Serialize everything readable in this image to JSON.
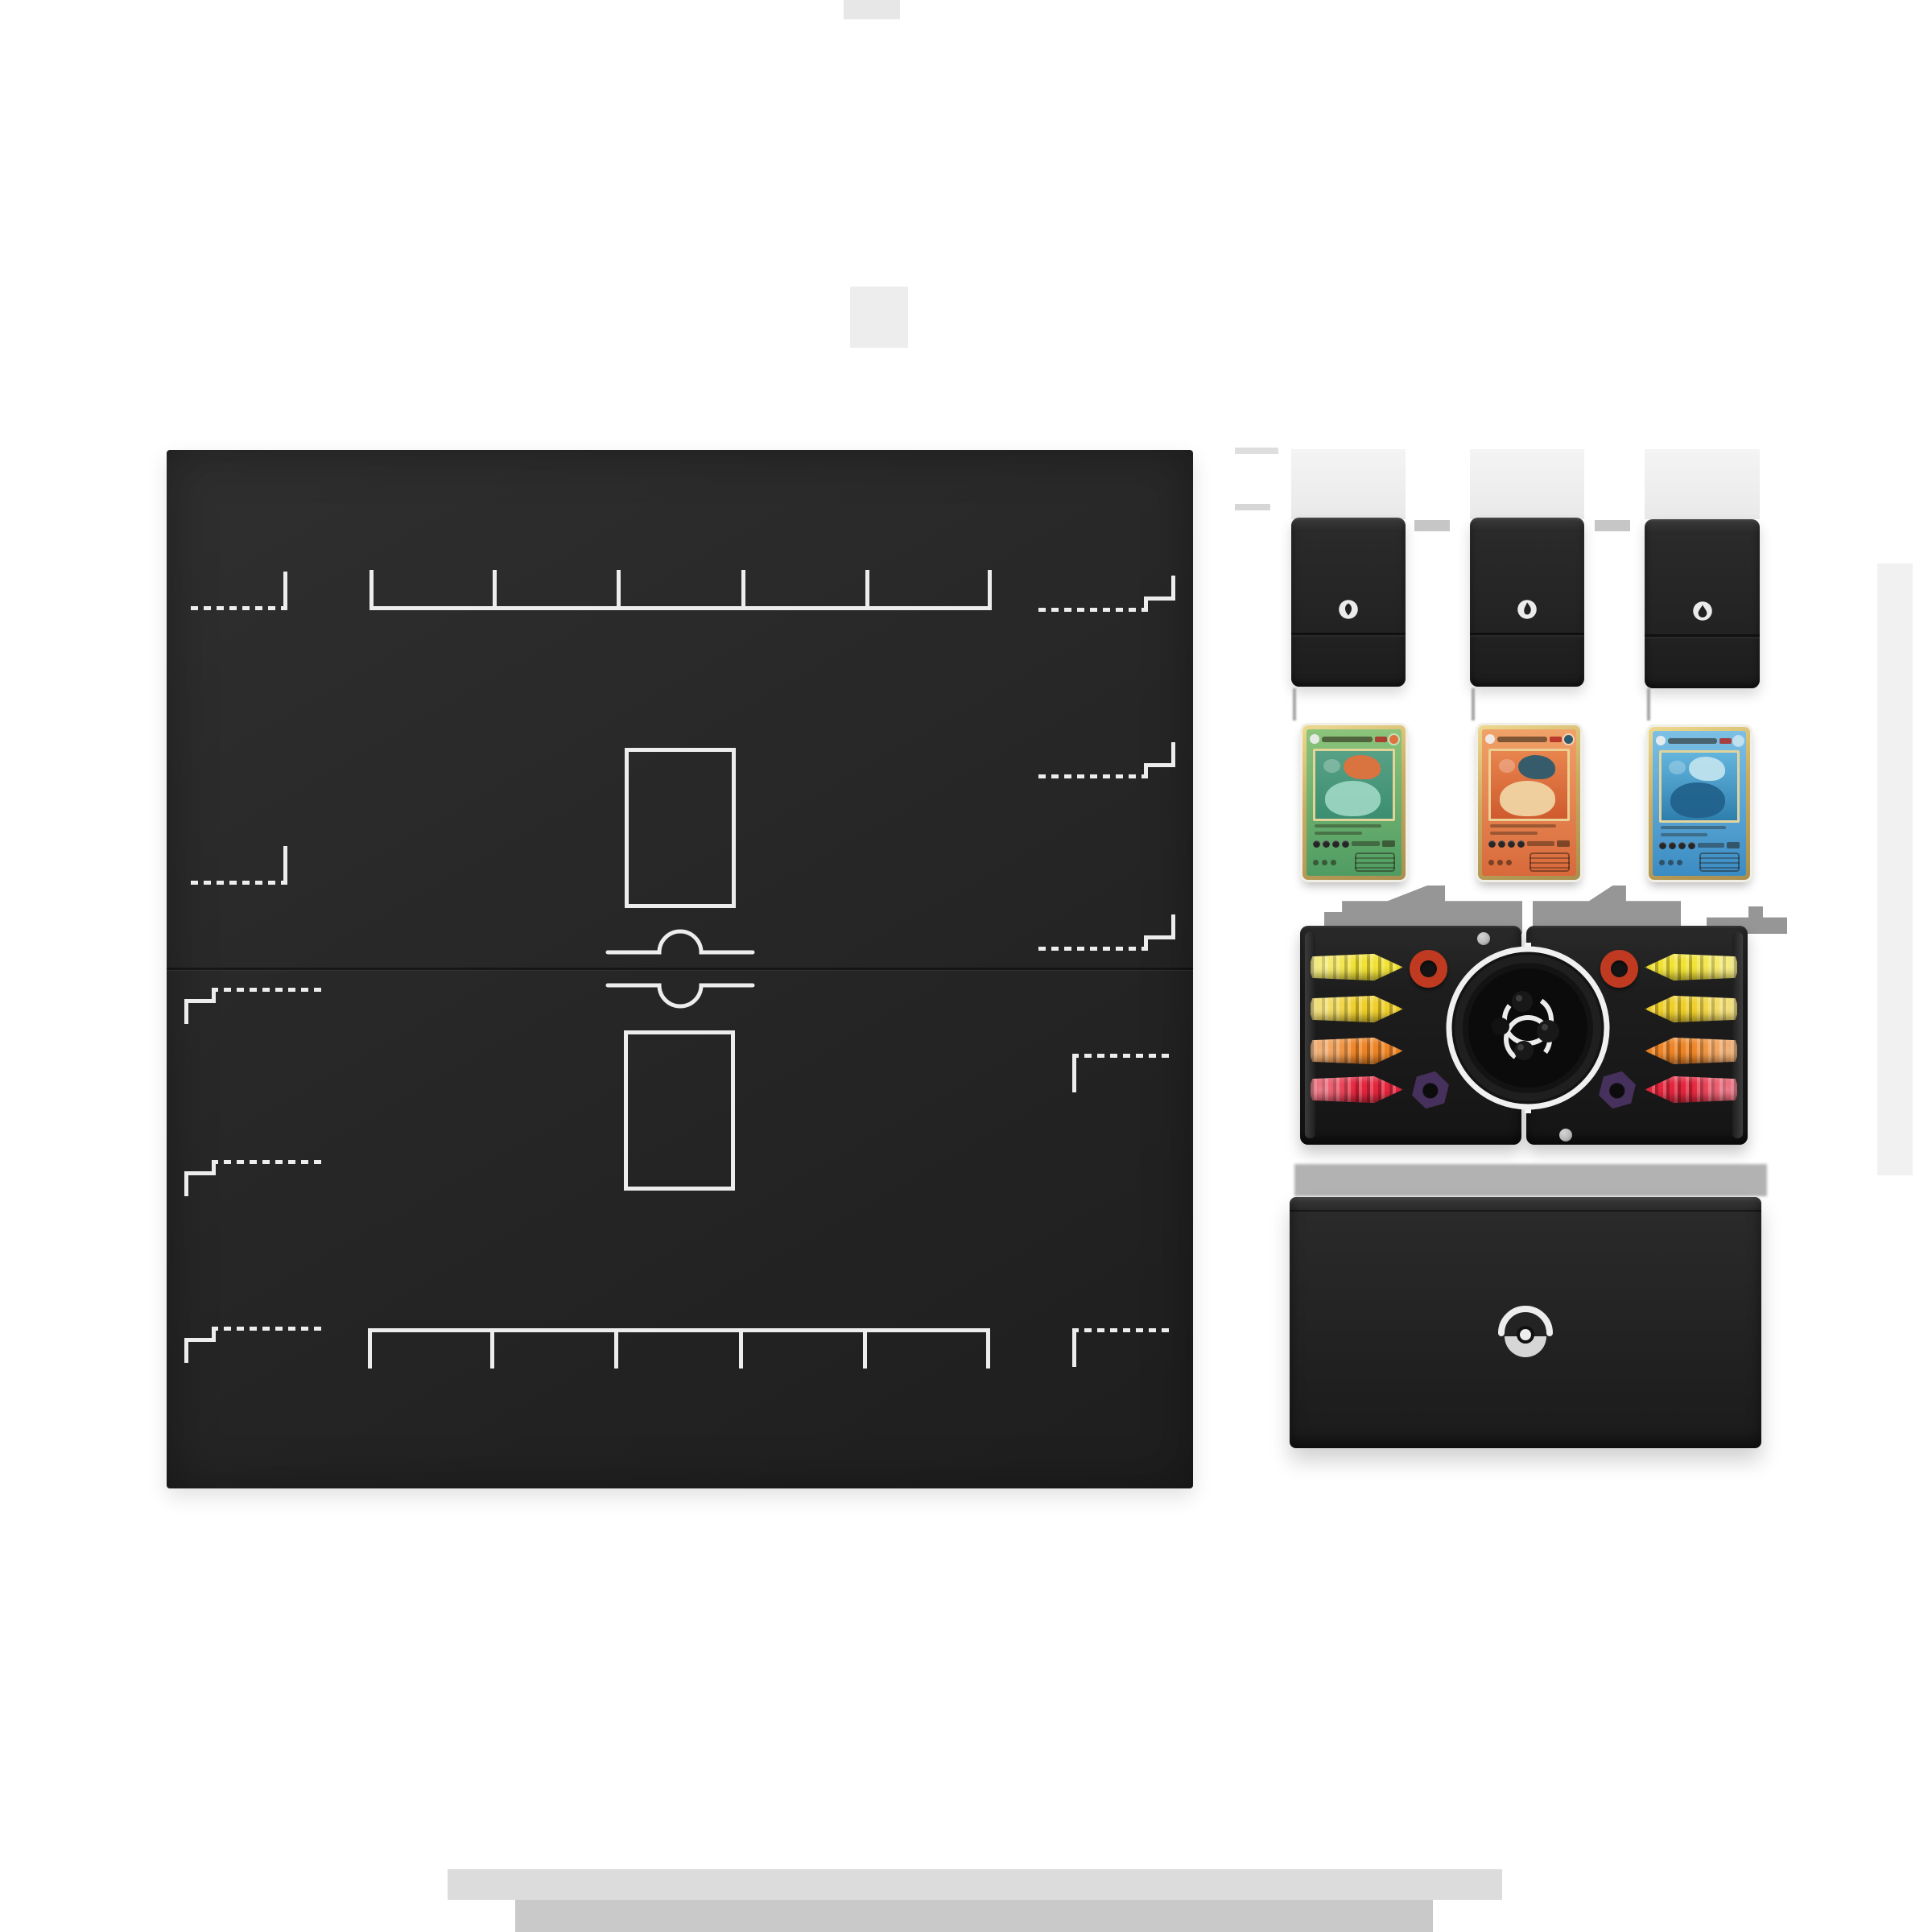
{
  "scene": {
    "background": "#ffffff"
  },
  "board": {
    "bg": "#272727",
    "line": "#ededed",
    "bench_slots": 5,
    "halves": 2,
    "stadium_zones": 2,
    "corner_marks_per_half": 2,
    "stepped_marks_per_half": 3,
    "pokeball_divider": "pokeball-seam-icon"
  },
  "deck_boxes": {
    "bg": "#242424",
    "emblem_bg": "#ebebeb",
    "emblem_glyph": "#212121",
    "items": [
      {
        "icon": "grass-energy-icon"
      },
      {
        "icon": "fire-energy-icon"
      },
      {
        "icon": "water-energy-icon"
      }
    ]
  },
  "cards": {
    "sleeve": "#f1eee6",
    "gold_light": "#ecd98f",
    "gold": "#c9ab62",
    "gold_dark": "#a98f4e",
    "items": [
      {
        "id": "venusaur-card",
        "body_light": "#8cc47a",
        "body": "#4f9c63",
        "art_a": "#57a186",
        "art_b": "#3c8e71",
        "accent": "#e0713c",
        "accent2": "#9fd8c4"
      },
      {
        "id": "charizard-card",
        "body_light": "#f0a268",
        "body": "#d9693b",
        "art_a": "#e8854e",
        "art_b": "#cf5a2e",
        "accent": "#2c5b6e",
        "accent2": "#f2d9a8"
      },
      {
        "id": "blastoise-card",
        "body_light": "#7cc0e4",
        "body": "#3b8cc4",
        "art_a": "#63b5dd",
        "art_b": "#2f7fae",
        "accent": "#bfe2ee",
        "accent2": "#1f5f8a"
      }
    ]
  },
  "tray": {
    "bg": "#1d1d1d",
    "counter_colors": [
      "#f1e233",
      "#efcf29",
      "#ee8425",
      "#e4253d"
    ],
    "ring_color": "#bf3a20",
    "nut_color": "#46305c",
    "die_ring": "#f0f0f0",
    "die_face": "#101010",
    "marble_color": "#b9b9b9",
    "counter_rows_per_side": 4
  },
  "storage_box": {
    "bg": "#232323",
    "emblem": "pokeball-icon",
    "emblem_light": "#ededed",
    "emblem_mid": "#d6d6d6",
    "emblem_dark": "#101010"
  }
}
